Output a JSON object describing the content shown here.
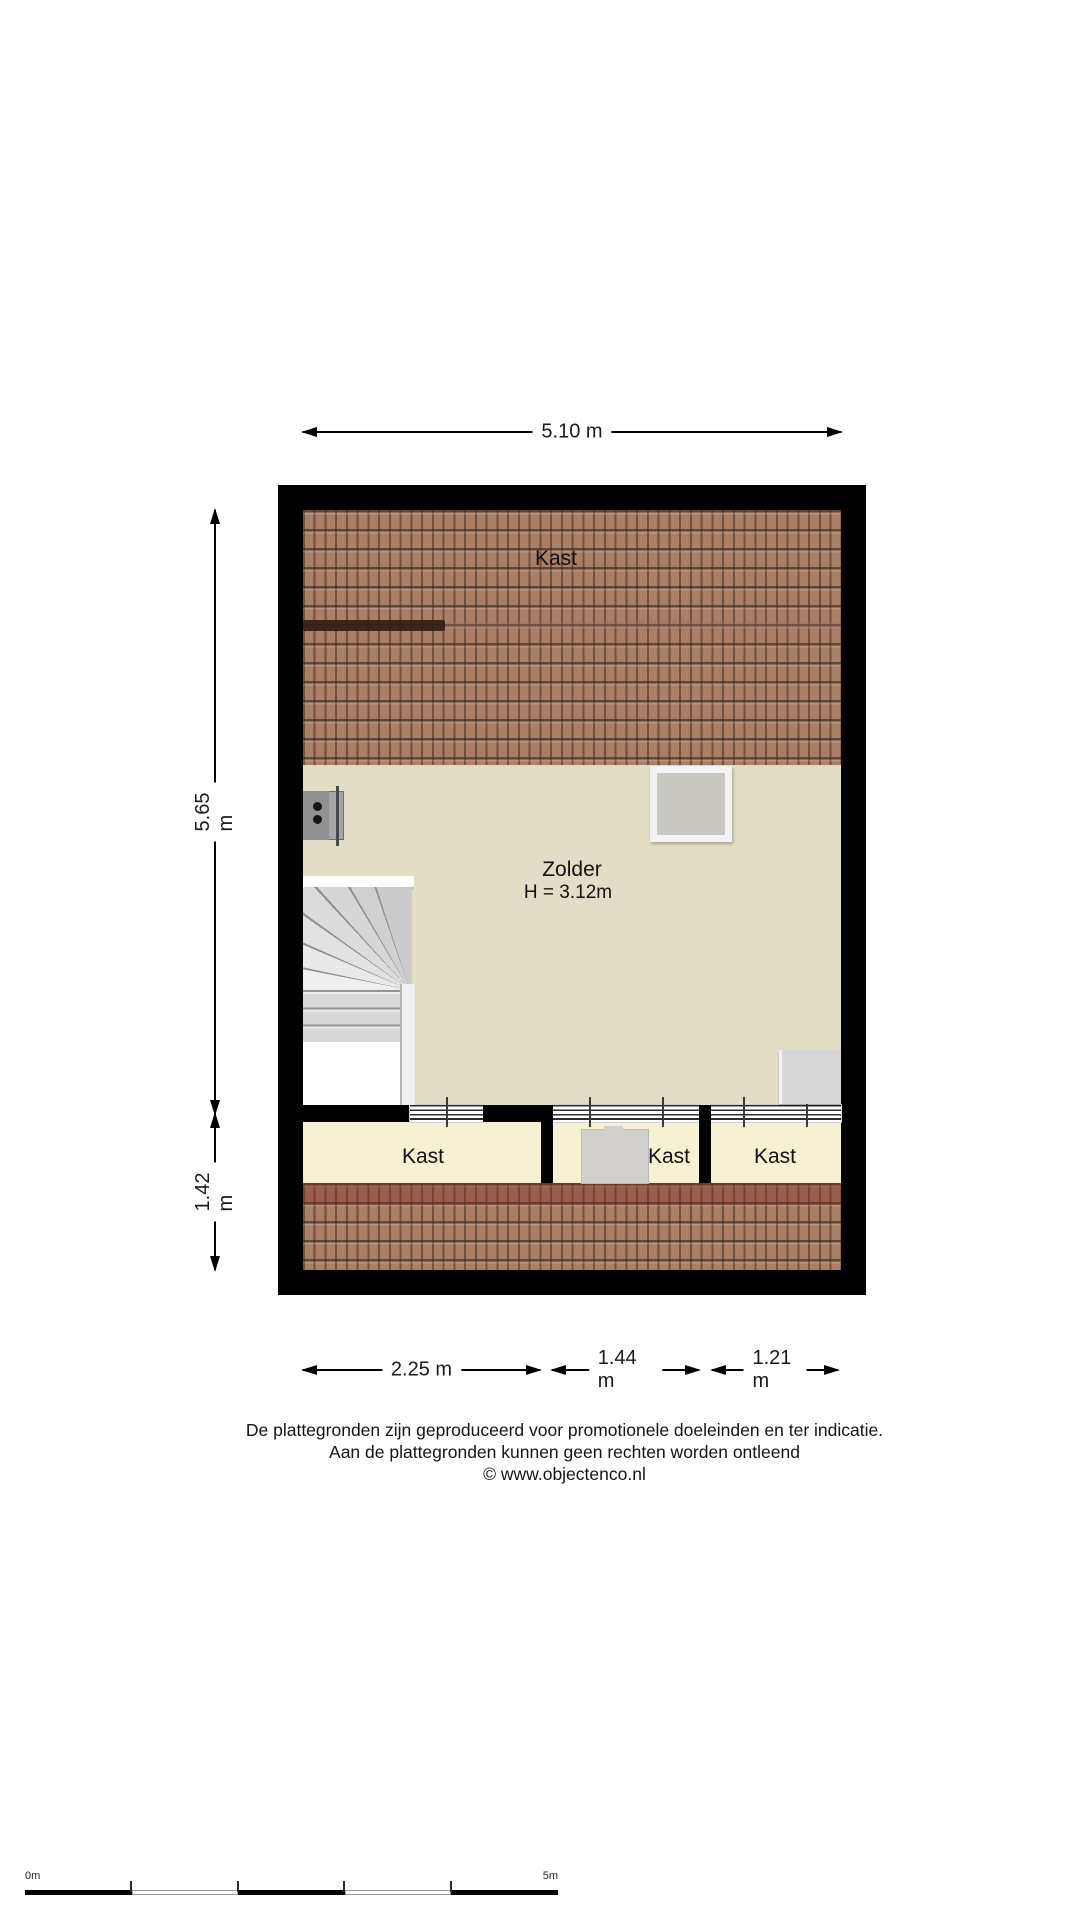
{
  "plan": {
    "rooms": {
      "roof_top_label": "Kast",
      "zolder_label": "Zolder",
      "zolder_height": "H = 3.12m",
      "kast_left_label": "Kast",
      "kast_middle_label": "Kast",
      "kast_right_label": "Kast"
    },
    "dimensions": {
      "top_width": "5.10 m",
      "left_upper": "5.65 m",
      "left_lower": "1.42 m",
      "bottom_left": "2.25 m",
      "bottom_middle": "1.44 m",
      "bottom_right": "1.21 m"
    },
    "colors": {
      "wall": "#000000",
      "attic_floor": "#e2ddc5",
      "closet_floor": "#f7f1d3",
      "roof_tile": "#ab7f66",
      "stair": "#d8d8d8"
    }
  },
  "footer": {
    "disclaimer_line1": "De plattegronden zijn geproduceerd voor promotionele doeleinden en ter indicatie.",
    "disclaimer_line2": "Aan de plattegronden kunnen geen rechten worden ontleend",
    "disclaimer_line3": "© www.objectenco.nl"
  },
  "scalebar": {
    "start_label": "0m",
    "end_label": "5m"
  }
}
